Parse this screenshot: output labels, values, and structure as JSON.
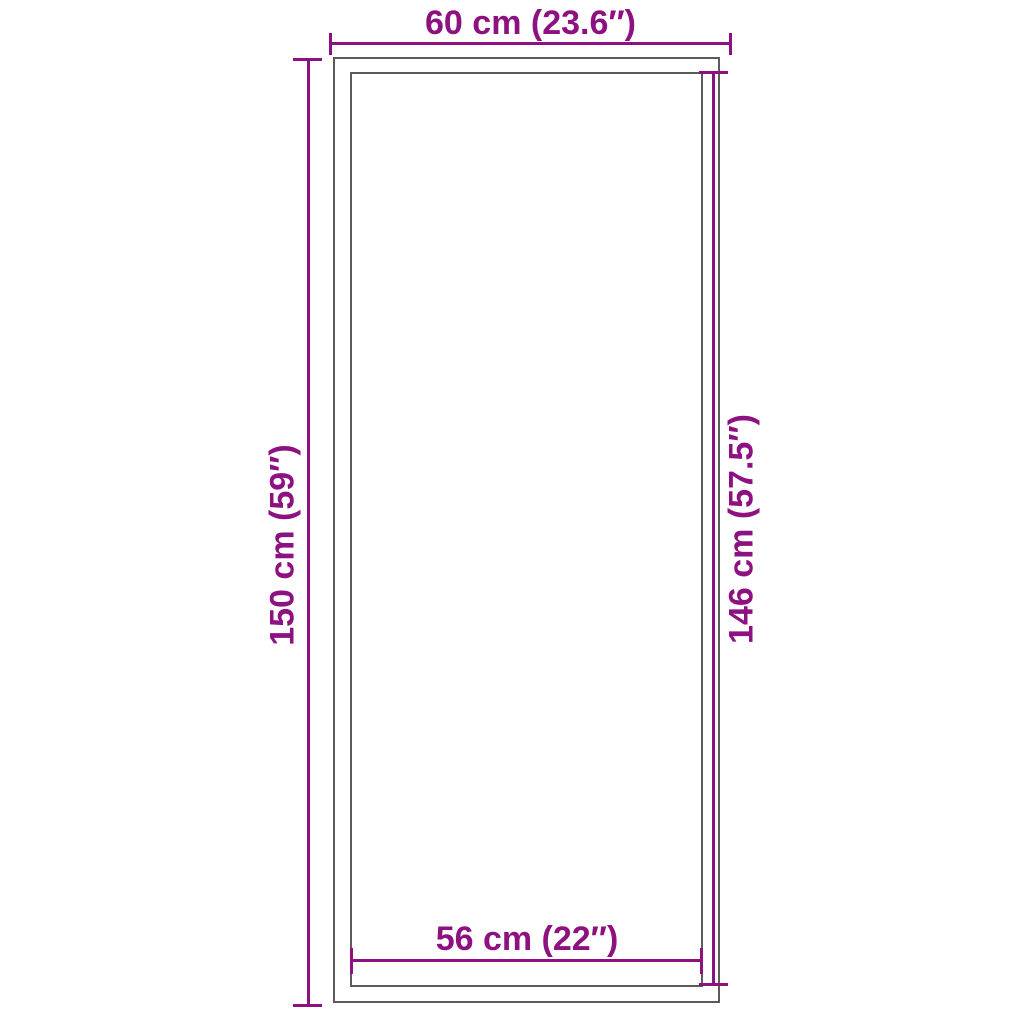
{
  "colors": {
    "accent": "#8E1182",
    "outline": "#5B5B5B",
    "background": "#FFFFFF"
  },
  "dimensions": {
    "top": {
      "label": "60 cm (23.6″)",
      "cm": 60,
      "inches": 23.6
    },
    "left": {
      "label": "150 cm (59″)",
      "cm": 150,
      "inches": 59
    },
    "right": {
      "label": "146 cm (57.5″)",
      "cm": 146,
      "inches": 57.5
    },
    "bottom": {
      "label": "56 cm (22″)",
      "cm": 56,
      "inches": 22
    }
  }
}
